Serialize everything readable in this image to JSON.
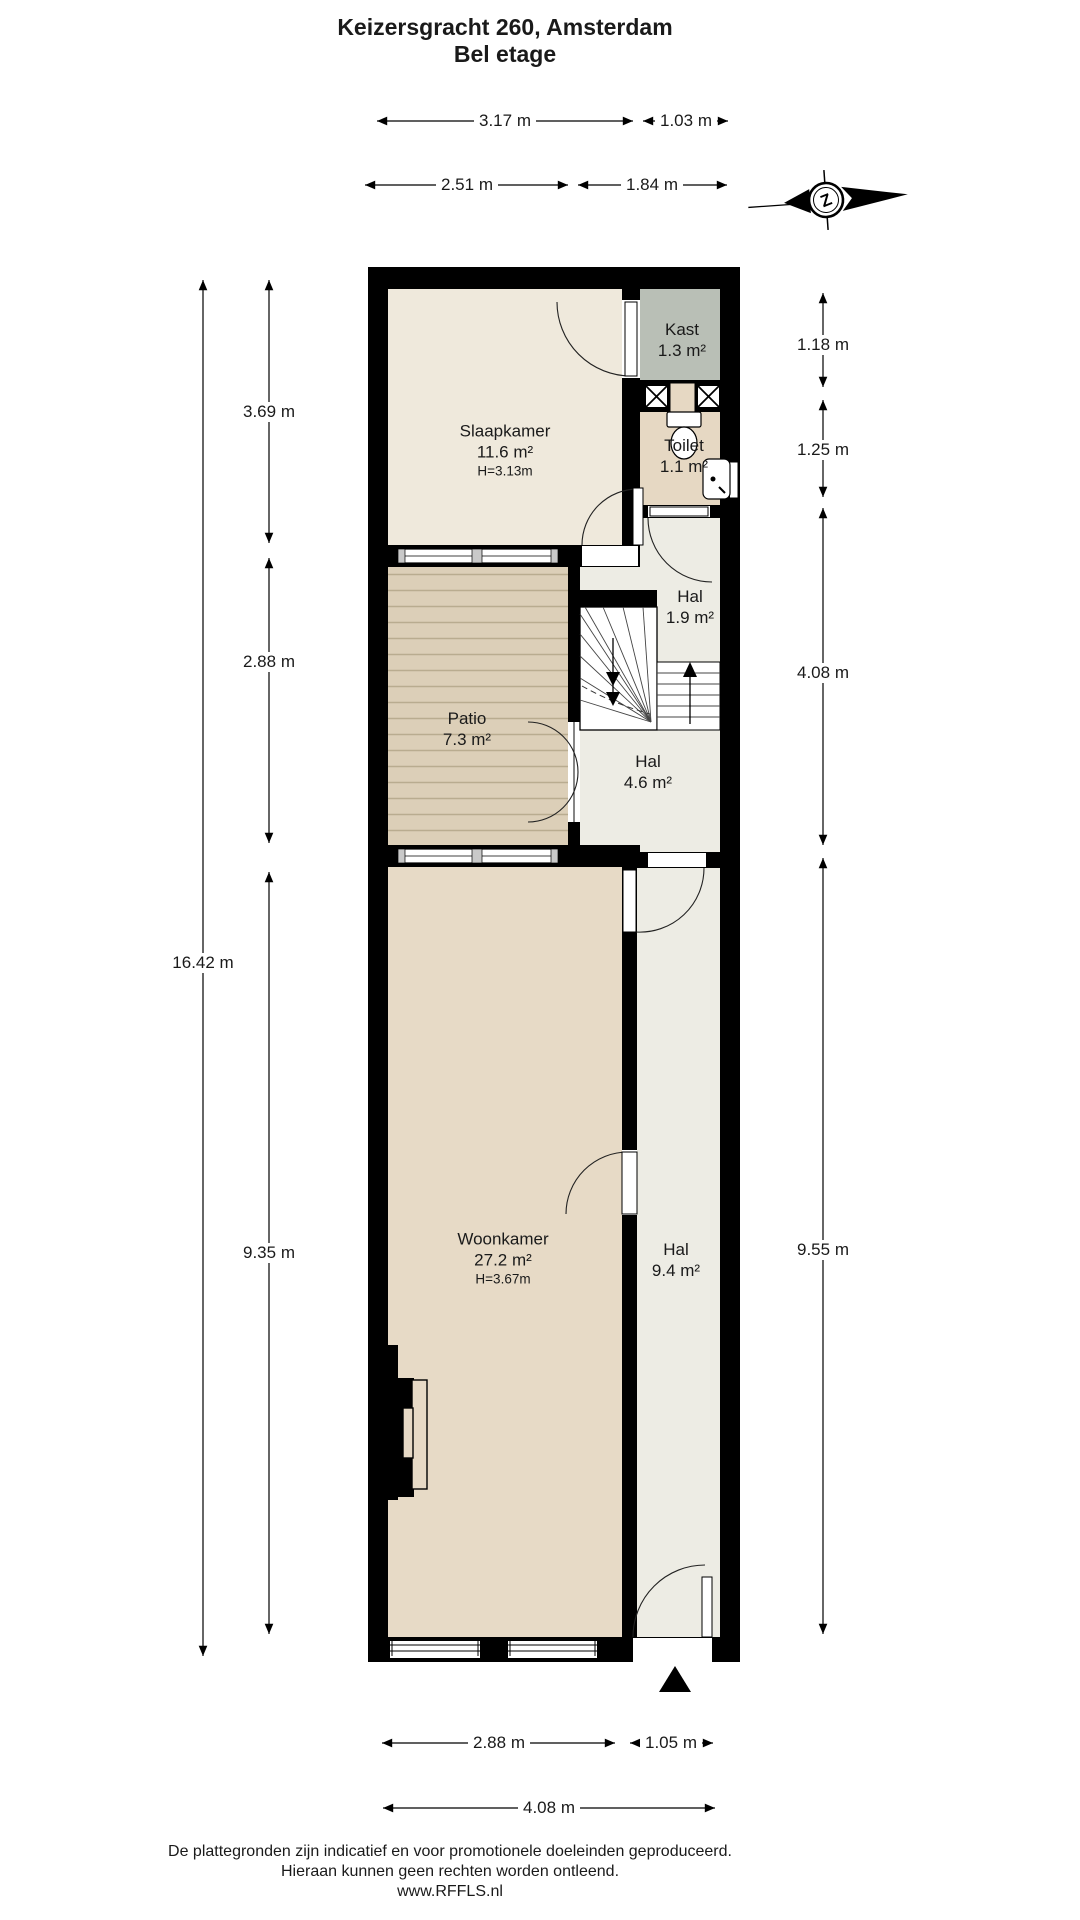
{
  "header": {
    "line1": "Keizersgracht 260, Amsterdam",
    "line2": "Bel etage"
  },
  "compass": {
    "letter": "Z"
  },
  "rooms": {
    "slaapkamer": {
      "name": "Slaapkamer",
      "area": "11.6 m²",
      "ceiling": "H=3.13m"
    },
    "kast": {
      "name": "Kast",
      "area": "1.3 m²"
    },
    "toilet": {
      "name": "Toilet",
      "area": "1.1 m²"
    },
    "hal_boven": {
      "name": "Hal",
      "area": "1.9 m²"
    },
    "patio": {
      "name": "Patio",
      "area": "7.3 m²"
    },
    "hal_tussen": {
      "name": "Hal",
      "area": "4.6 m²"
    },
    "woonkamer": {
      "name": "Woonkamer",
      "area": "27.2 m²",
      "ceiling": "H=3.67m"
    },
    "hal_beneden": {
      "name": "Hal",
      "area": "9.4 m²"
    }
  },
  "dims": {
    "top": [
      "3.17 m",
      "1.03 m",
      "2.51 m",
      "1.84 m"
    ],
    "left": [
      "3.69 m",
      "2.88 m",
      "16.42 m",
      "9.35 m"
    ],
    "right": [
      "1.18 m",
      "1.25 m",
      "4.08 m",
      "9.55 m"
    ],
    "bottom": [
      "2.88 m",
      "1.05 m",
      "4.08 m"
    ]
  },
  "footer": {
    "line1": "De plattegronden zijn indicatief en voor promotionele doeleinden geproduceerd.",
    "line2": "Hieraan kunnen geen rechten worden ontleend.",
    "line3": "www.RFFLS.nl"
  },
  "colors": {
    "wall": "#000000",
    "slaapkamer": "#efe9dc",
    "kast": "#b9bfb6",
    "toilet": "#e6d8c3",
    "hal": "#edece4",
    "woonkamer": "#e7dac6",
    "patio_deck": "#dccfb8",
    "patio_stripe": "#b9ac90",
    "stairs": "#ffffff"
  }
}
